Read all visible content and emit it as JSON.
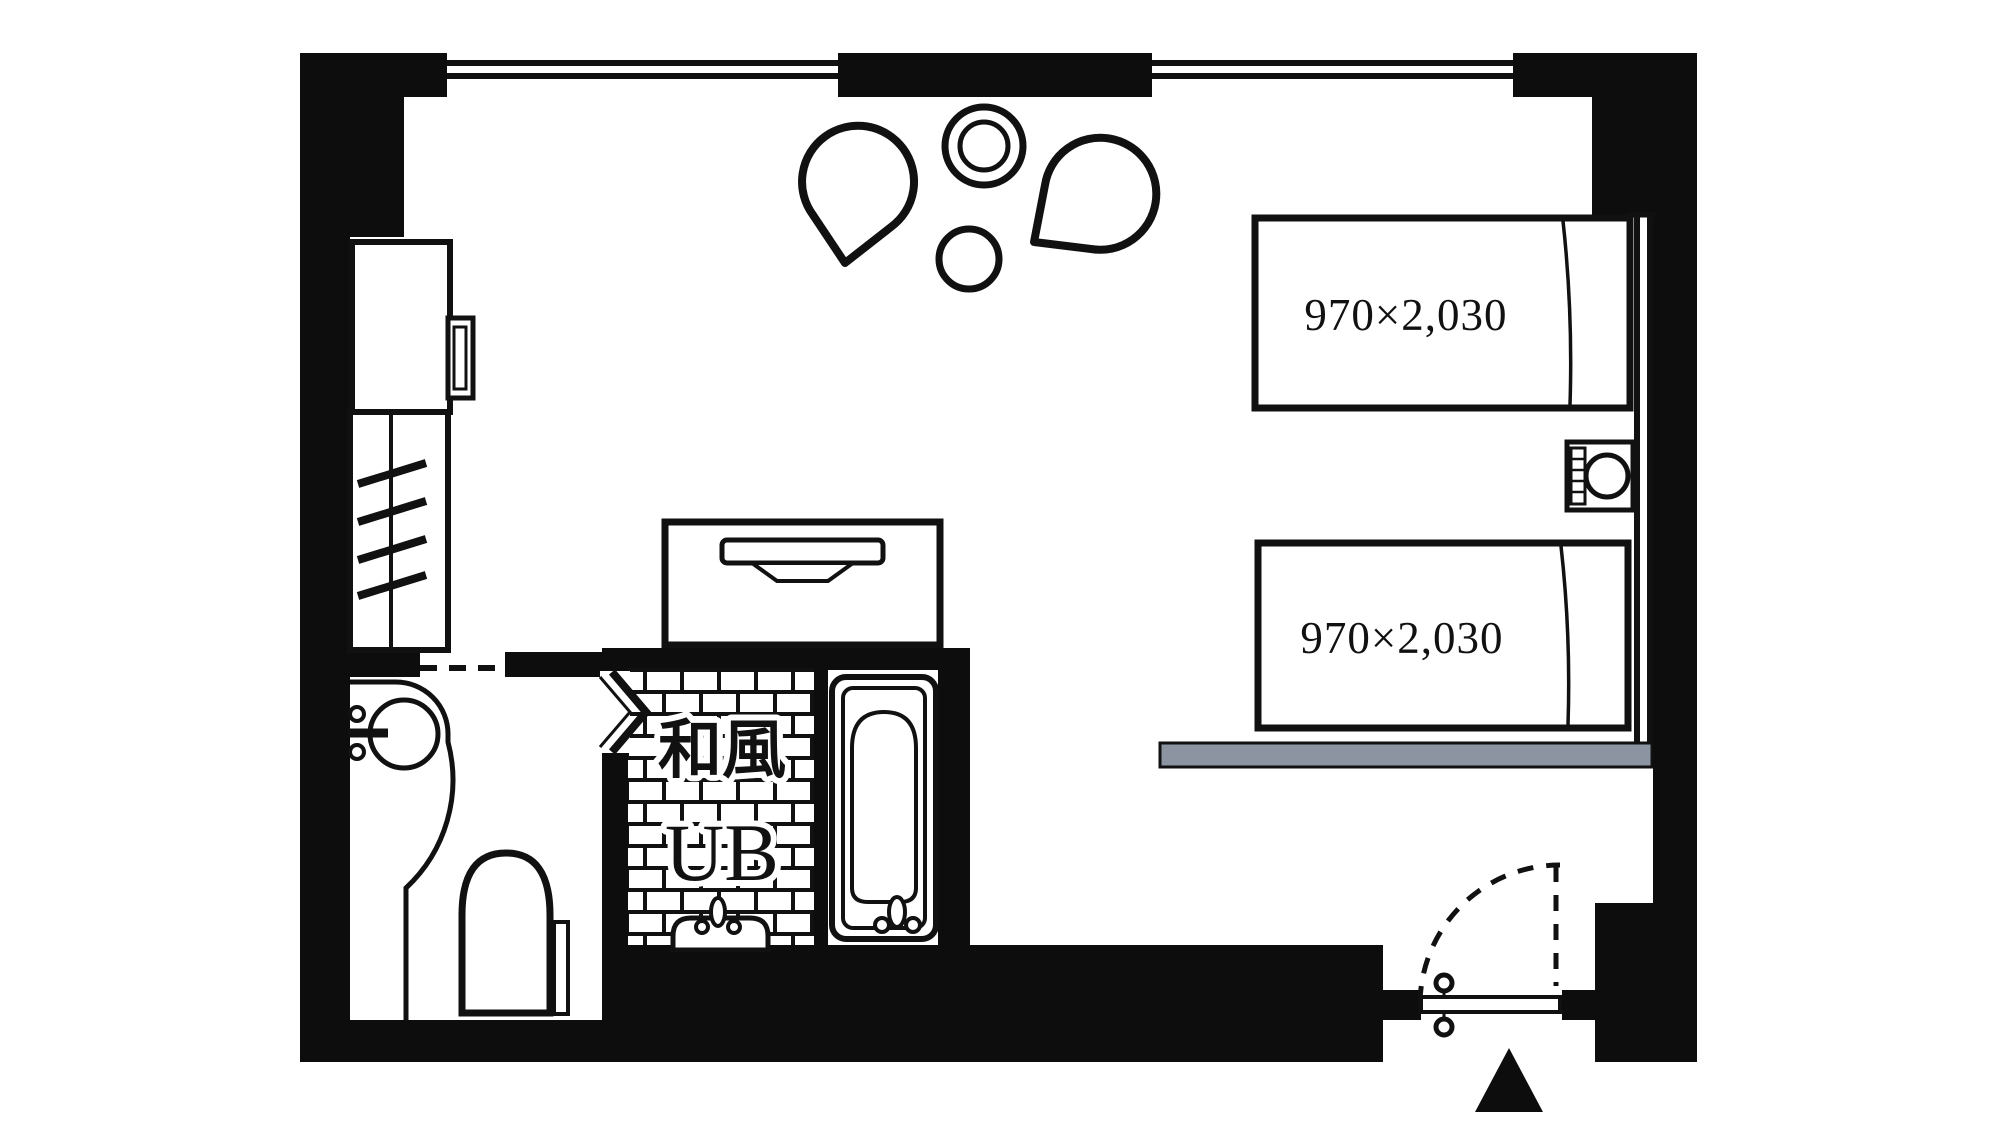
{
  "plan": {
    "type": "hotel-room-floorplan",
    "colors": {
      "wall": "#0d0d0d",
      "line": "#111111",
      "floor": "#ffffff",
      "bench_gray": "#8c94a2"
    },
    "beds": [
      {
        "label": "970×2,030"
      },
      {
        "label": "970×2,030"
      }
    ],
    "bathroom": {
      "style_label": "和風",
      "unit_label": "UB"
    }
  }
}
